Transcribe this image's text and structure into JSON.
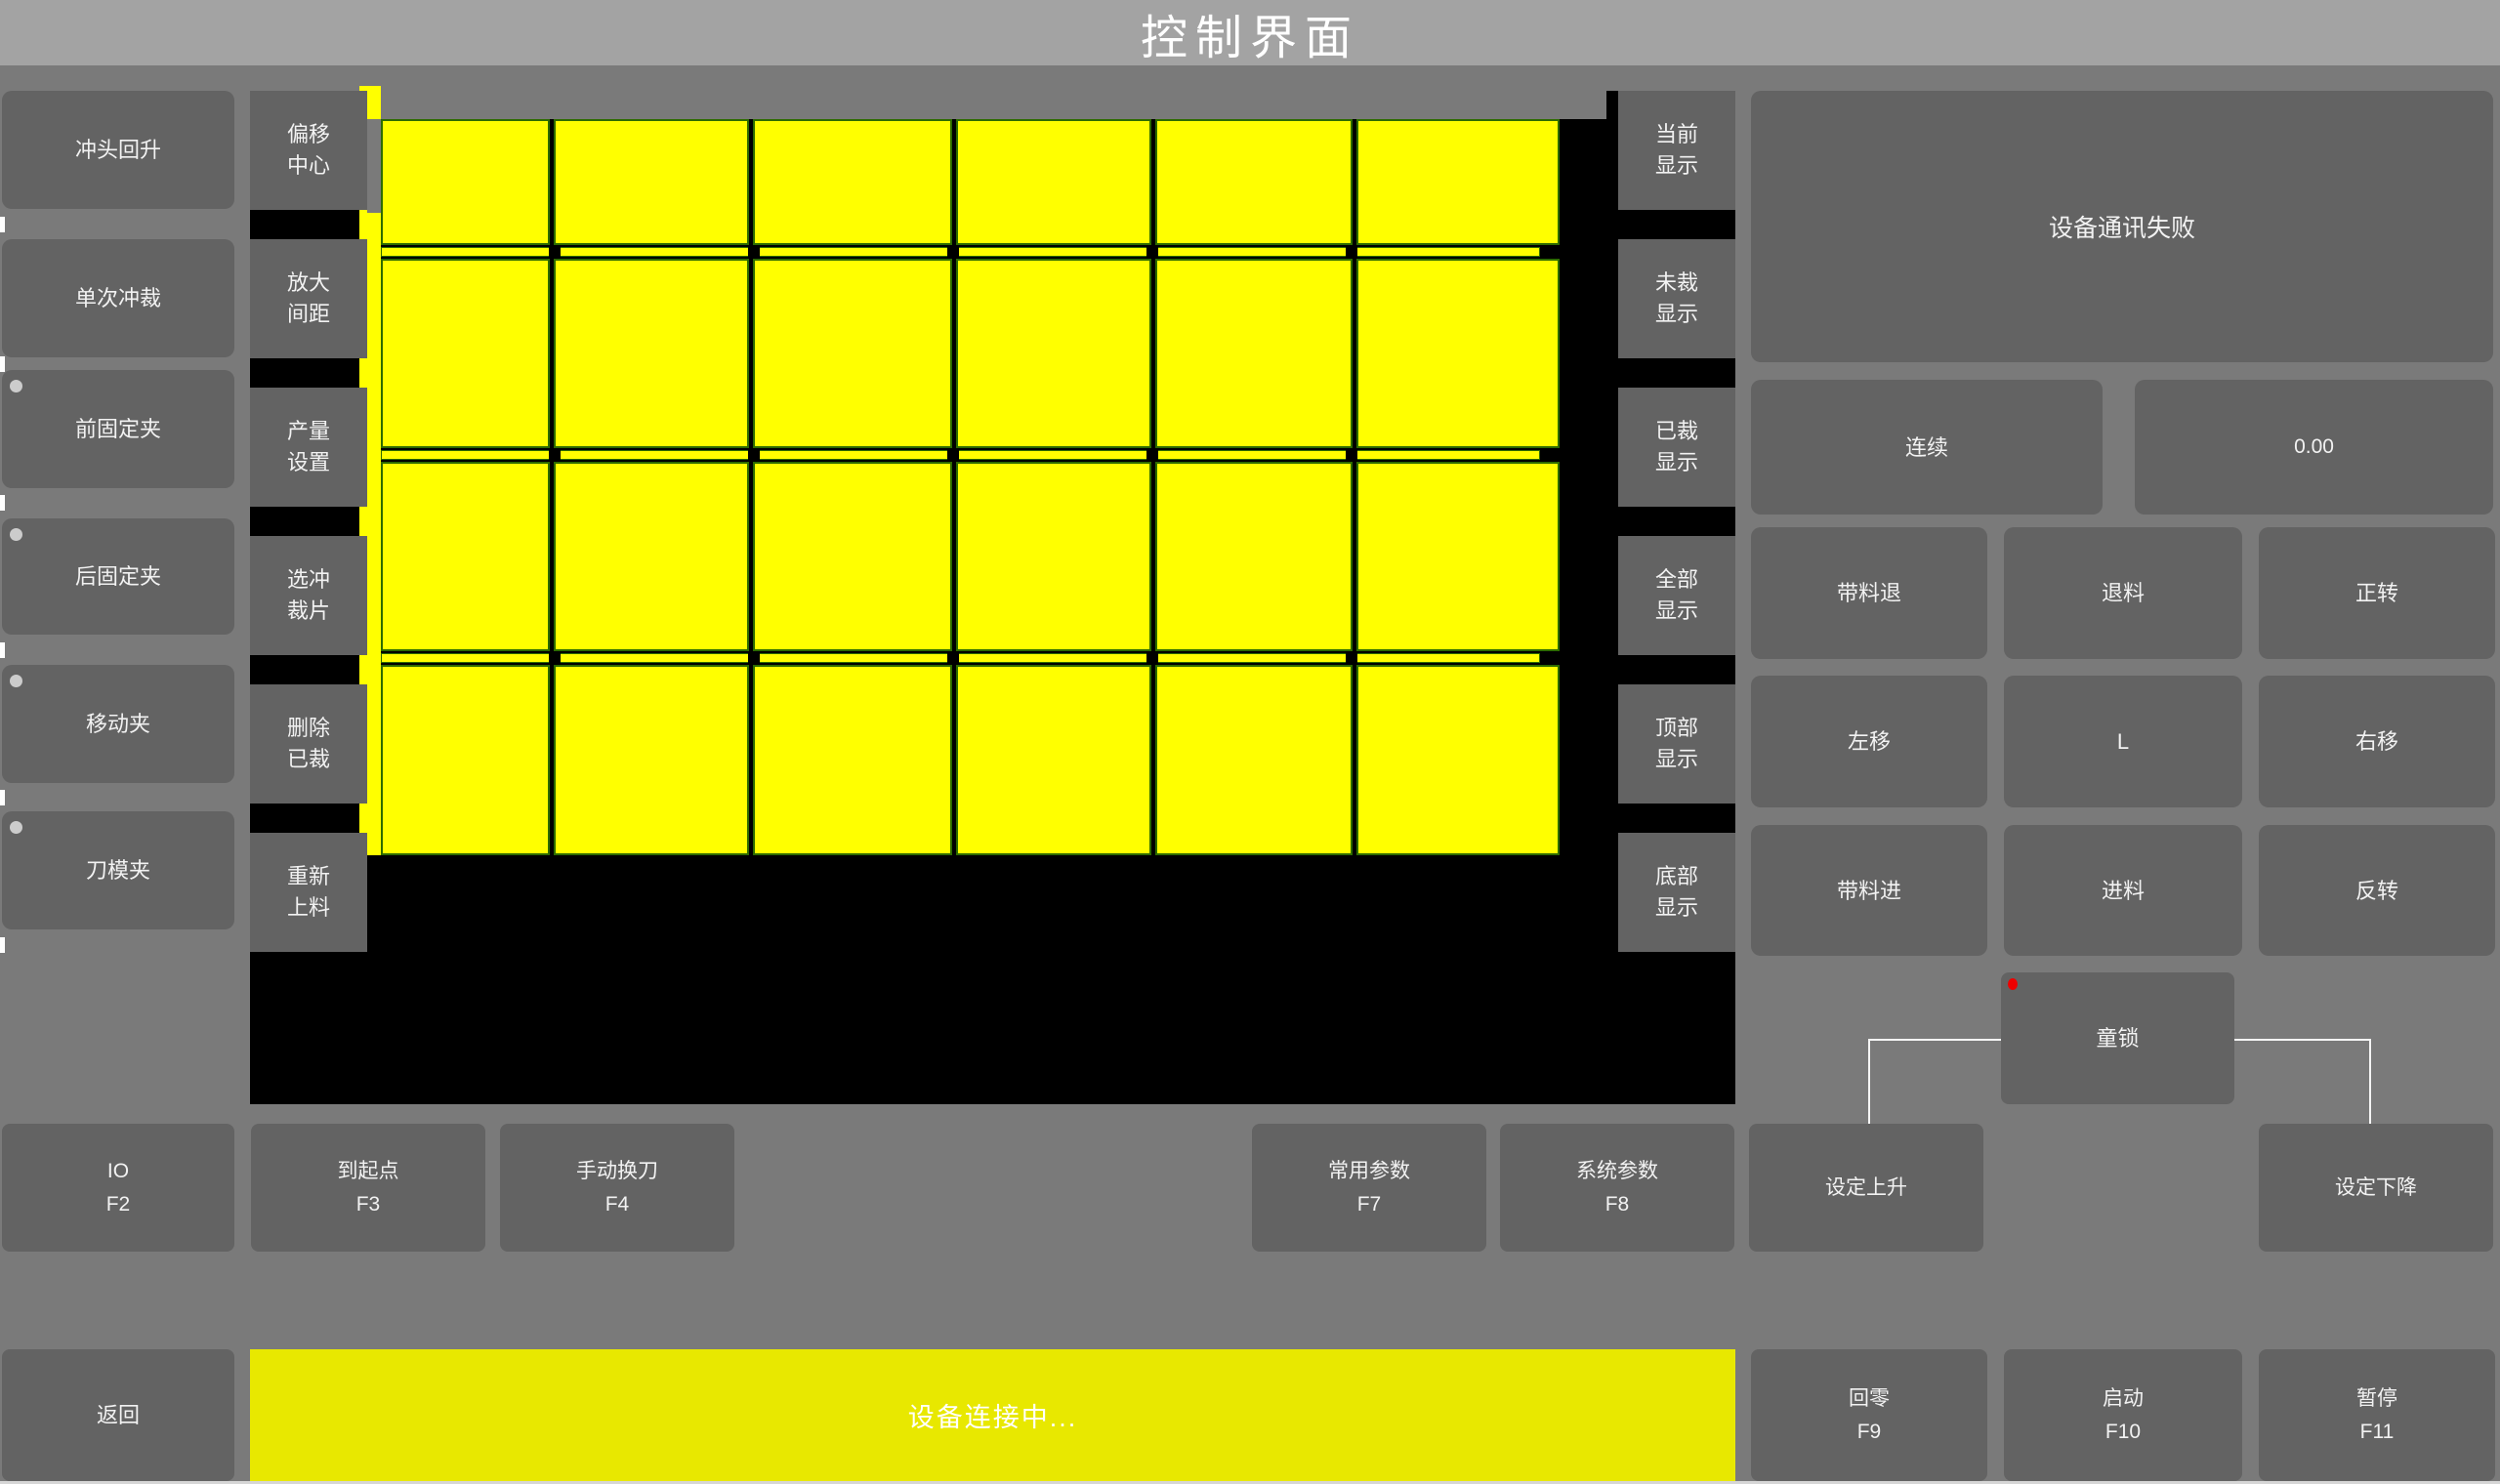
{
  "title": "控制界面",
  "colors": {
    "page_bg": "#7a7a7a",
    "titlebar_bg": "#a3a3a3",
    "button_bg": "#636363",
    "canvas_bg": "#000000",
    "piece_yellow": "#ffff00",
    "status_yellow": "#e8e800",
    "indicator_dot": "#cccccc",
    "alert_dot": "#ee0000",
    "piece_border": "#2d6b00"
  },
  "left_panel": {
    "buttons": [
      {
        "label": "冲头回升",
        "indicator": false
      },
      {
        "label": "单次冲裁",
        "indicator": false
      },
      {
        "label": "前固定夹",
        "indicator": true
      },
      {
        "label": "后固定夹",
        "indicator": true
      },
      {
        "label": "移动夹",
        "indicator": true
      },
      {
        "label": "刀模夹",
        "indicator": true
      }
    ]
  },
  "tool_panel": {
    "buttons": [
      "偏移中心",
      "放大间距",
      "产量设置",
      "选冲裁片",
      "删除已裁",
      "重新上料"
    ]
  },
  "display_panel": {
    "buttons": [
      "当前显示",
      "未裁显示",
      "已裁显示",
      "全部显示",
      "顶部显示",
      "底部显示"
    ]
  },
  "status_panel": {
    "message": "设备通讯失败",
    "mode_button": "连续",
    "value": "0.00"
  },
  "jog_panel": {
    "buttons": [
      "带料退",
      "退料",
      "正转",
      "左移",
      "L",
      "右移",
      "带料进",
      "进料",
      "反转"
    ],
    "child_lock": "童锁"
  },
  "function_row": {
    "buttons": [
      {
        "label": "IO",
        "fkey": "F2"
      },
      {
        "label": "到起点",
        "fkey": "F3"
      },
      {
        "label": "手动换刀",
        "fkey": "F4"
      },
      {
        "label": "常用参数",
        "fkey": "F7"
      },
      {
        "label": "系统参数",
        "fkey": "F8"
      },
      {
        "label": "设定上升",
        "fkey": ""
      },
      {
        "label": "设定下降",
        "fkey": ""
      }
    ]
  },
  "bottom_bar": {
    "back_button": "返回",
    "status_message": "设备连接中...",
    "buttons": [
      {
        "label": "回零",
        "fkey": "F9"
      },
      {
        "label": "启动",
        "fkey": "F10"
      },
      {
        "label": "暂停",
        "fkey": "F11"
      }
    ]
  },
  "canvas": {
    "rows": 4,
    "cols": 6
  }
}
